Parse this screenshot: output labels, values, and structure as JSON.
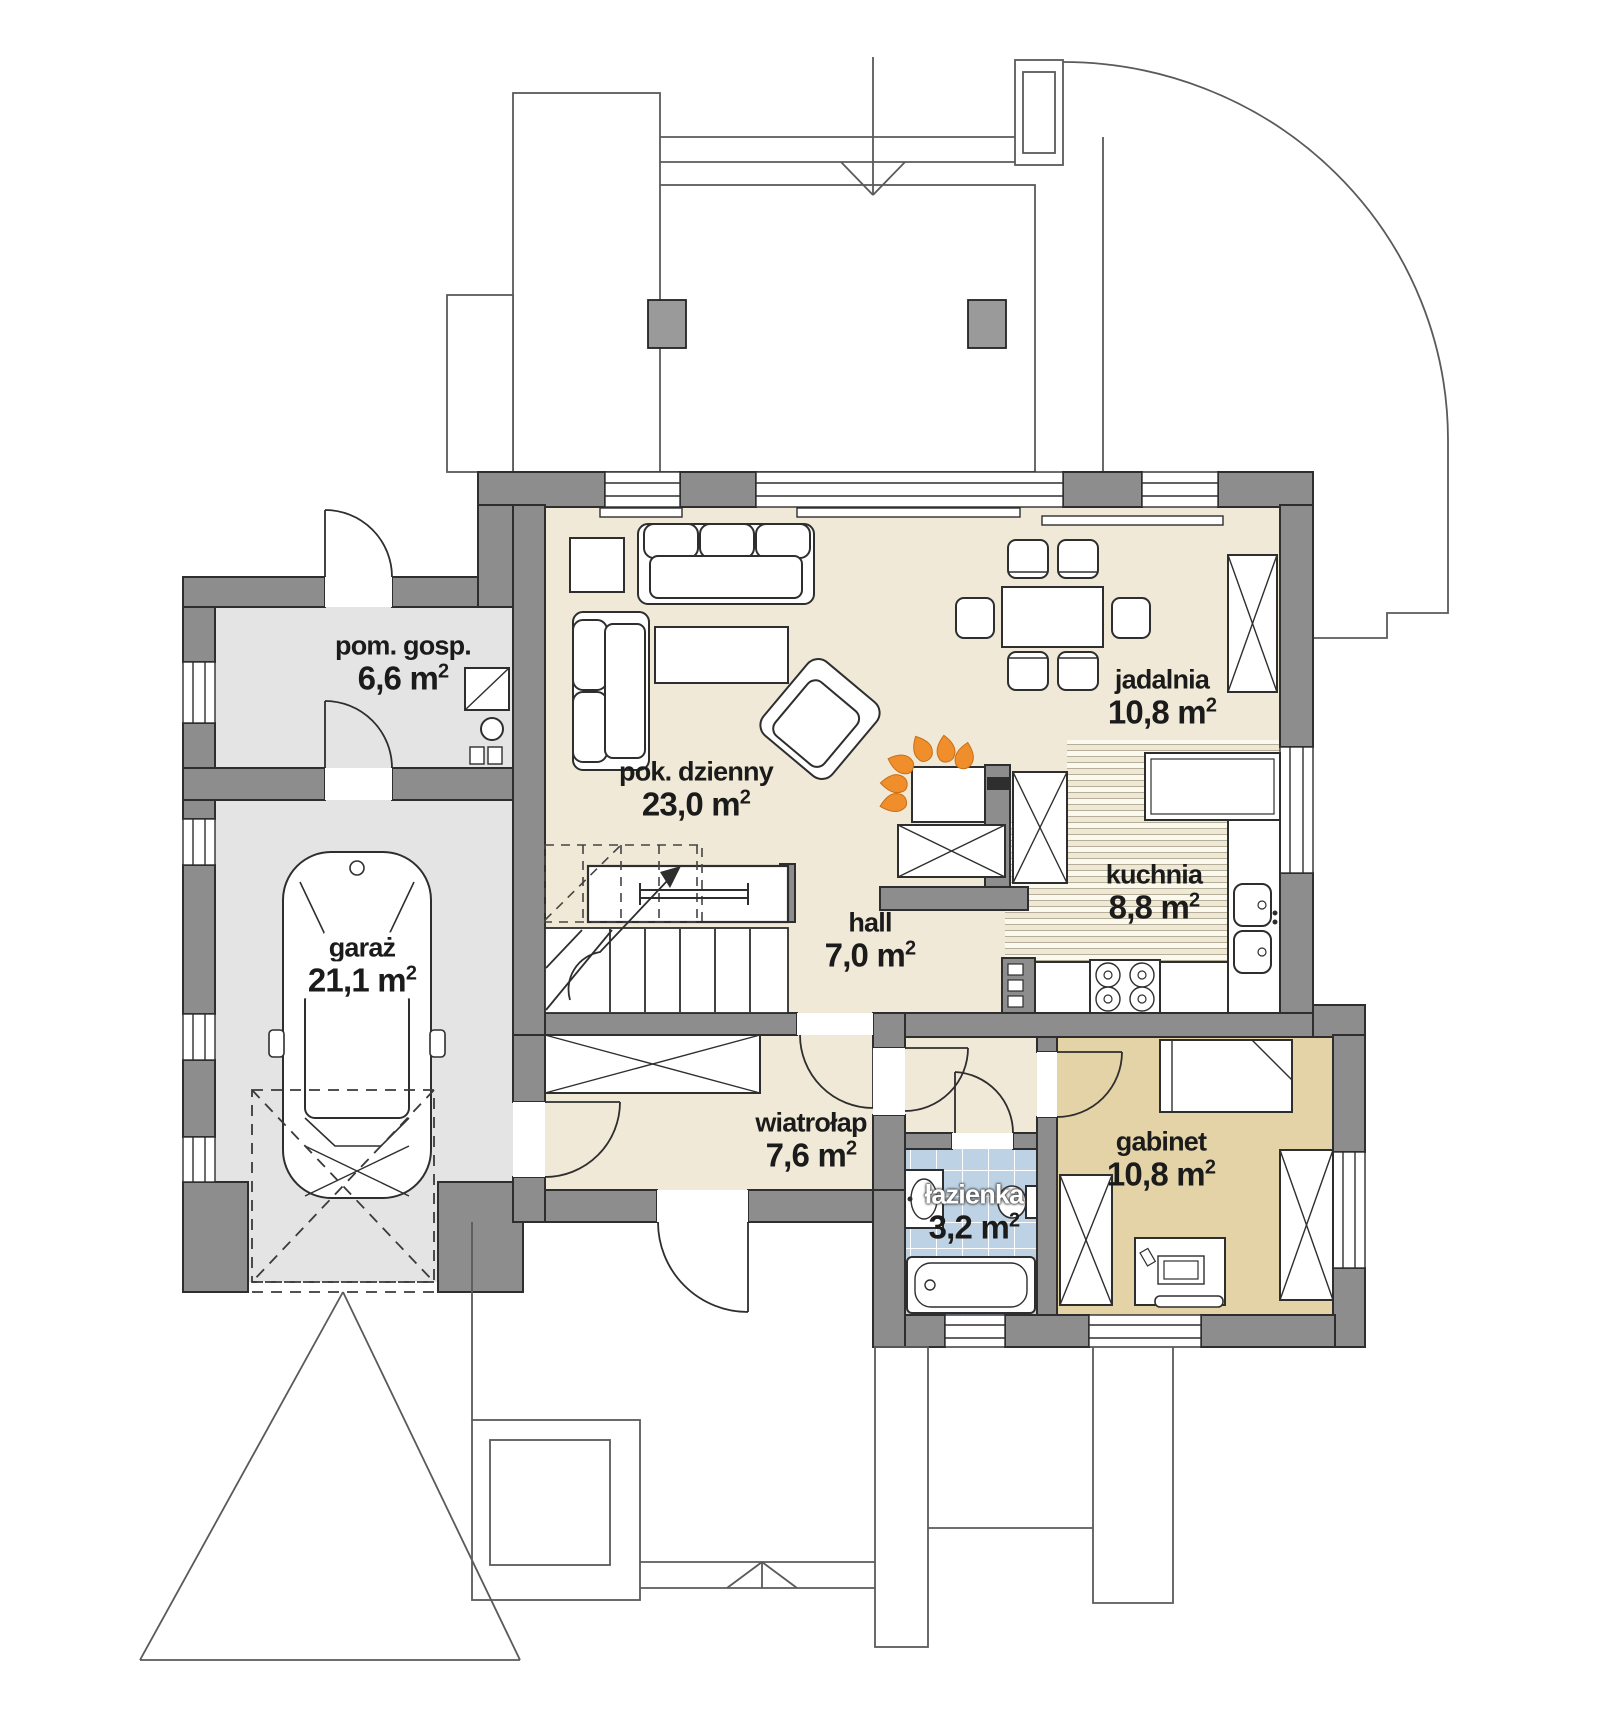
{
  "sup": "2",
  "rooms": [
    {
      "id": "pom-gosp",
      "name": "pom. gosp.",
      "area": "6,6 m"
    },
    {
      "id": "garaz",
      "name": "garaż",
      "area": "21,1 m"
    },
    {
      "id": "pok-dzienny",
      "name": "pok. dzienny",
      "area": "23,0 m"
    },
    {
      "id": "jadalnia",
      "name": "jadalnia",
      "area": "10,8 m"
    },
    {
      "id": "kuchnia",
      "name": "kuchnia",
      "area": "8,8 m"
    },
    {
      "id": "hall",
      "name": "hall",
      "area": "7,0 m"
    },
    {
      "id": "wiatrolap",
      "name": "wiatrołap",
      "area": "7,6 m"
    },
    {
      "id": "lazienka",
      "name": "łazienka",
      "area": "3,2 m"
    },
    {
      "id": "gabinet",
      "name": "gabinet",
      "area": "10,8 m"
    }
  ],
  "colors": {
    "wall": "#8d8d8d",
    "floor_beige": "#f0e9d7",
    "floor_gray": "#e4e4e4",
    "floor_tan": "#e3d3a6",
    "floor_tile_blue": "#bdd2e4",
    "flame_orange": "#ef8e2b"
  }
}
